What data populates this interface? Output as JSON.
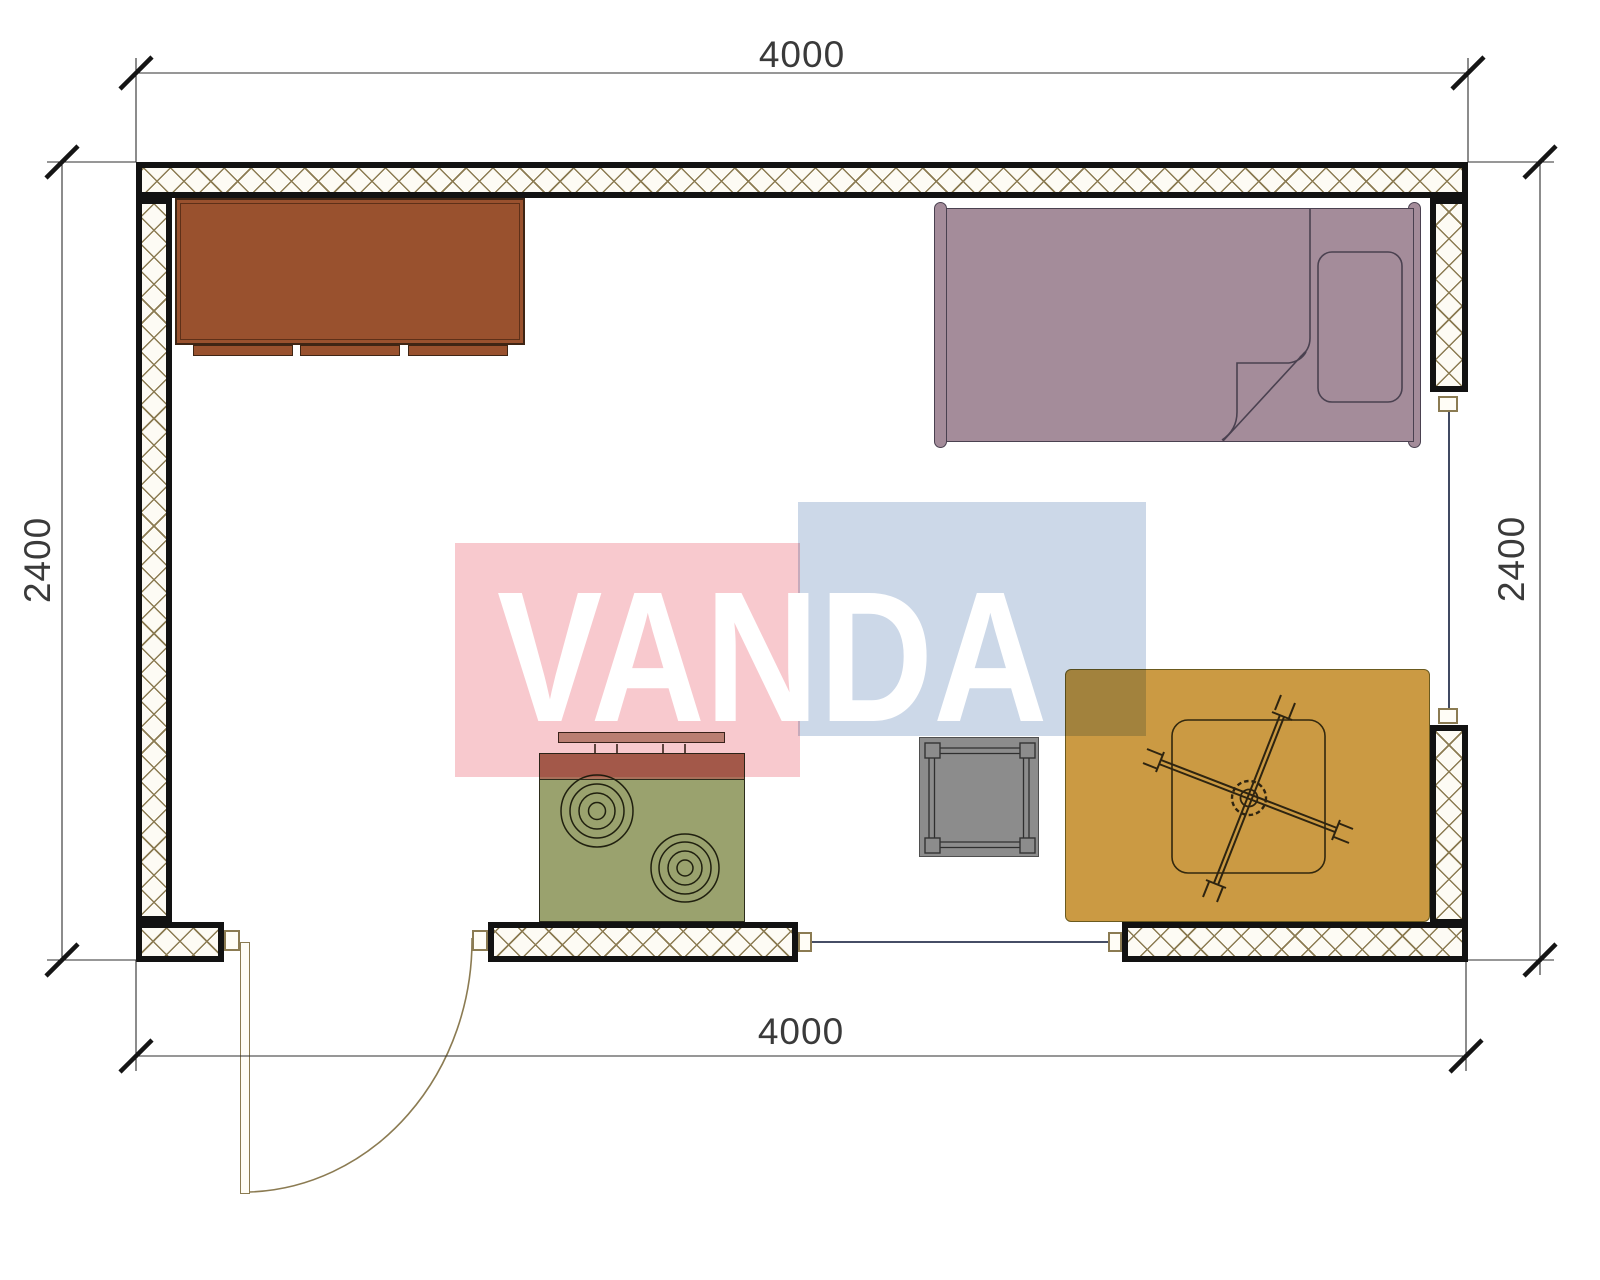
{
  "plan": {
    "type": "room-floor-plan",
    "room_width_mm": "4000",
    "room_depth_mm": "2400"
  },
  "dimensions": {
    "top": {
      "label": "4000"
    },
    "bottom": {
      "label": "4000"
    },
    "left": {
      "label": "2400"
    },
    "right": {
      "label": "2400"
    }
  },
  "watermark": {
    "text": "VANDA",
    "pink_color": "#f8c9ce",
    "blue_color": "#ccd8e8",
    "text_color": "#ffffff"
  },
  "colors": {
    "wall_line": "#121212",
    "wall_hatch": "#8b7b52",
    "wardrobe": "#99512e",
    "bed": "#a48c9a",
    "stove_body": "#9aa26e",
    "stove_back": "#a8705a",
    "shelf": "#bfa08d",
    "stool": "#8c8c8c",
    "rug": "#cb9a43",
    "dimension_text": "#3a3a3a",
    "window_line": "#2b3550",
    "door_line": "#8b7b52"
  }
}
